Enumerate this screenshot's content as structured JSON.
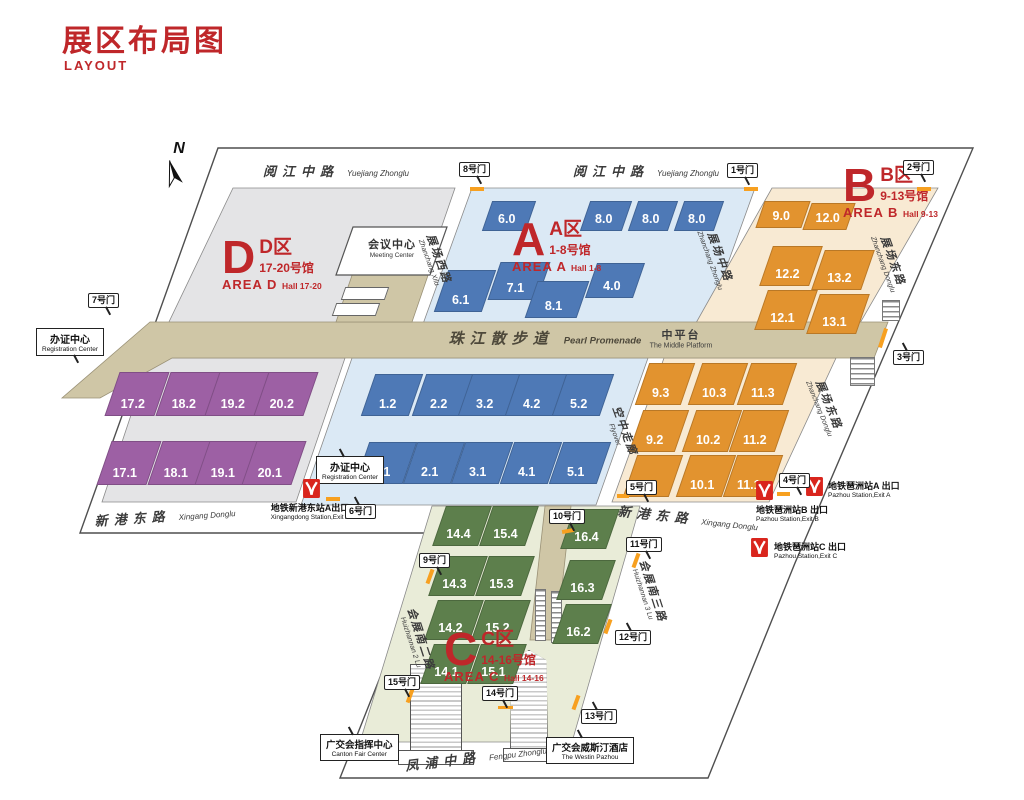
{
  "title": {
    "zh": "展区布局图",
    "en": "LAYOUT"
  },
  "compass_label": "N",
  "areas": {
    "a": {
      "letter": "A",
      "zone_zh": "A区",
      "halls_zh": "1-8号馆",
      "area_en": "AREA A",
      "halls_en": "Hall 1-8"
    },
    "b": {
      "letter": "B",
      "zone_zh": "B区",
      "halls_zh": "9-13号馆",
      "area_en": "AREA B",
      "halls_en": "Hall 9-13"
    },
    "c": {
      "letter": "C",
      "zone_zh": "C区",
      "halls_zh": "14-16号馆",
      "area_en": "AREA C",
      "halls_en": "Hall 14-16"
    },
    "d": {
      "letter": "D",
      "zone_zh": "D区",
      "halls_zh": "17-20号馆",
      "area_en": "AREA D",
      "halls_en": "Hall 17-20"
    }
  },
  "halls": {
    "a": [
      "6.0",
      "8.0",
      "8.0",
      "8.0",
      "6.1",
      "7.1",
      "8.1",
      "4.0",
      "1.2",
      "2.2",
      "3.2",
      "4.2",
      "5.2",
      "1.1",
      "2.1",
      "3.1",
      "4.1",
      "5.1"
    ],
    "b": [
      "9.0",
      "12.0",
      "12.2",
      "13.2",
      "12.1",
      "13.1",
      "9.3",
      "10.3",
      "11.3",
      "9.2",
      "10.2",
      "11.2",
      "9.1",
      "10.1",
      "11.1"
    ],
    "c": [
      "14.4",
      "15.4",
      "16.4",
      "14.3",
      "15.3",
      "16.3",
      "14.2",
      "15.2",
      "16.2",
      "14.1",
      "15.1"
    ],
    "d": [
      "17.2",
      "18.2",
      "19.2",
      "20.2",
      "17.1",
      "18.1",
      "19.1",
      "20.1"
    ]
  },
  "gates": [
    "1号门",
    "2号门",
    "3号门",
    "4号门",
    "5号门",
    "6号门",
    "7号门",
    "8号门",
    "9号门",
    "10号门",
    "11号门",
    "12号门",
    "13号门",
    "14号门",
    "15号门"
  ],
  "roads": {
    "yuejiang": {
      "zh": "阅江中路",
      "en": "Yuejiang Zhonglu"
    },
    "xingang": {
      "zh": "新港东路",
      "en": "Xingang Donglu"
    },
    "fengpu": {
      "zh": "凤浦中路",
      "en": "Fengpu Zhonglu"
    },
    "zhanchang_xi": {
      "zh": "展场西路",
      "en": "Zhanchang Xilu"
    },
    "zhanchang_zhong": {
      "zh": "展场中路",
      "en": "Zhanchang Zhonglu"
    },
    "zhanchang_dong": {
      "zh": "展场东路",
      "en": "Zhanchang Donglu"
    },
    "flyover": {
      "zh": "空中走廊",
      "en": "Flyover"
    },
    "huizhan_2": {
      "zh": "会展南二路",
      "en": "Huizhannan 2 Lu"
    },
    "huizhan_3": {
      "zh": "会展南三路",
      "en": "Huizhannan 3 Lu"
    }
  },
  "promenade": {
    "zh": "珠江散步道",
    "en": "Pearl Promenade"
  },
  "platform": {
    "zh": "中平台",
    "en": "The Middle Platform"
  },
  "facilities": {
    "meeting_center": {
      "zh": "会议中心",
      "en": "Meeting Center"
    },
    "registration_center": {
      "zh": "办证中心",
      "en": "Registration Center"
    },
    "canton_fair_center": {
      "zh": "广交会指挥中心",
      "en": "Canton Fair Center"
    },
    "westin": {
      "zh": "广交会威斯汀酒店",
      "en": "The Westin Pazhou"
    }
  },
  "metro": [
    {
      "zh": "地铁新港东站A出口",
      "en": "Xingangdong Station,Exit A"
    },
    {
      "zh": "地铁琶洲站A 出口",
      "en": "Pazhou Station,Exit A"
    },
    {
      "zh": "地铁琶洲站B 出口",
      "en": "Pazhou Station,Exit B"
    },
    {
      "zh": "地铁琶洲站C 出口",
      "en": "Pazhou Station,Exit C"
    }
  ],
  "colors": {
    "accent_red": "#bf272a",
    "hall_blue": "#4e79b6",
    "hall_purple": "#9d60a4",
    "hall_orange": "#e2932f",
    "hall_green": "#5d7f4c",
    "metro_red": "#d9251d",
    "gate_mark_orange": "#f7a020"
  }
}
